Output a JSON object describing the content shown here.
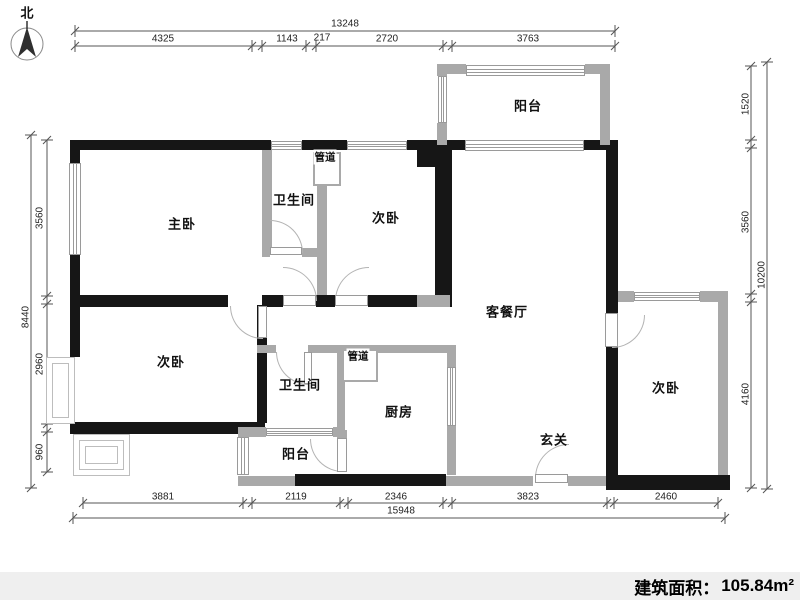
{
  "compass": {
    "label": "北"
  },
  "rooms": {
    "master_bedroom": "主卧",
    "bath_upper": "卫生间",
    "duct_upper": "管道",
    "bedroom_top": "次卧",
    "balcony_top": "阳台",
    "living_dining": "客餐厅",
    "bedroom_left": "次卧",
    "bath_lower": "卫生间",
    "duct_lower": "管道",
    "kitchen": "厨房",
    "balcony_bottom": "阳台",
    "entry": "玄关",
    "bedroom_right": "次卧"
  },
  "dimensions": {
    "top": {
      "total": "13248",
      "segments": [
        "4325",
        "1143",
        "217",
        "2720",
        "3763"
      ]
    },
    "left": {
      "total": "8440",
      "segments": [
        "3560",
        "2960",
        "960"
      ]
    },
    "right": {
      "total": "10200",
      "segments": [
        "1520",
        "3560",
        "4160"
      ]
    },
    "bottom": {
      "total": "15948",
      "segments": [
        "3881",
        "2119",
        "2346",
        "3823",
        "2460"
      ]
    }
  },
  "footer": {
    "area_label": "建筑面积：",
    "area_value": "105.84m²"
  },
  "colors": {
    "wall_exterior": "#161616",
    "wall_interior": "#a9a9a9",
    "footer_bg": "#efefef"
  }
}
